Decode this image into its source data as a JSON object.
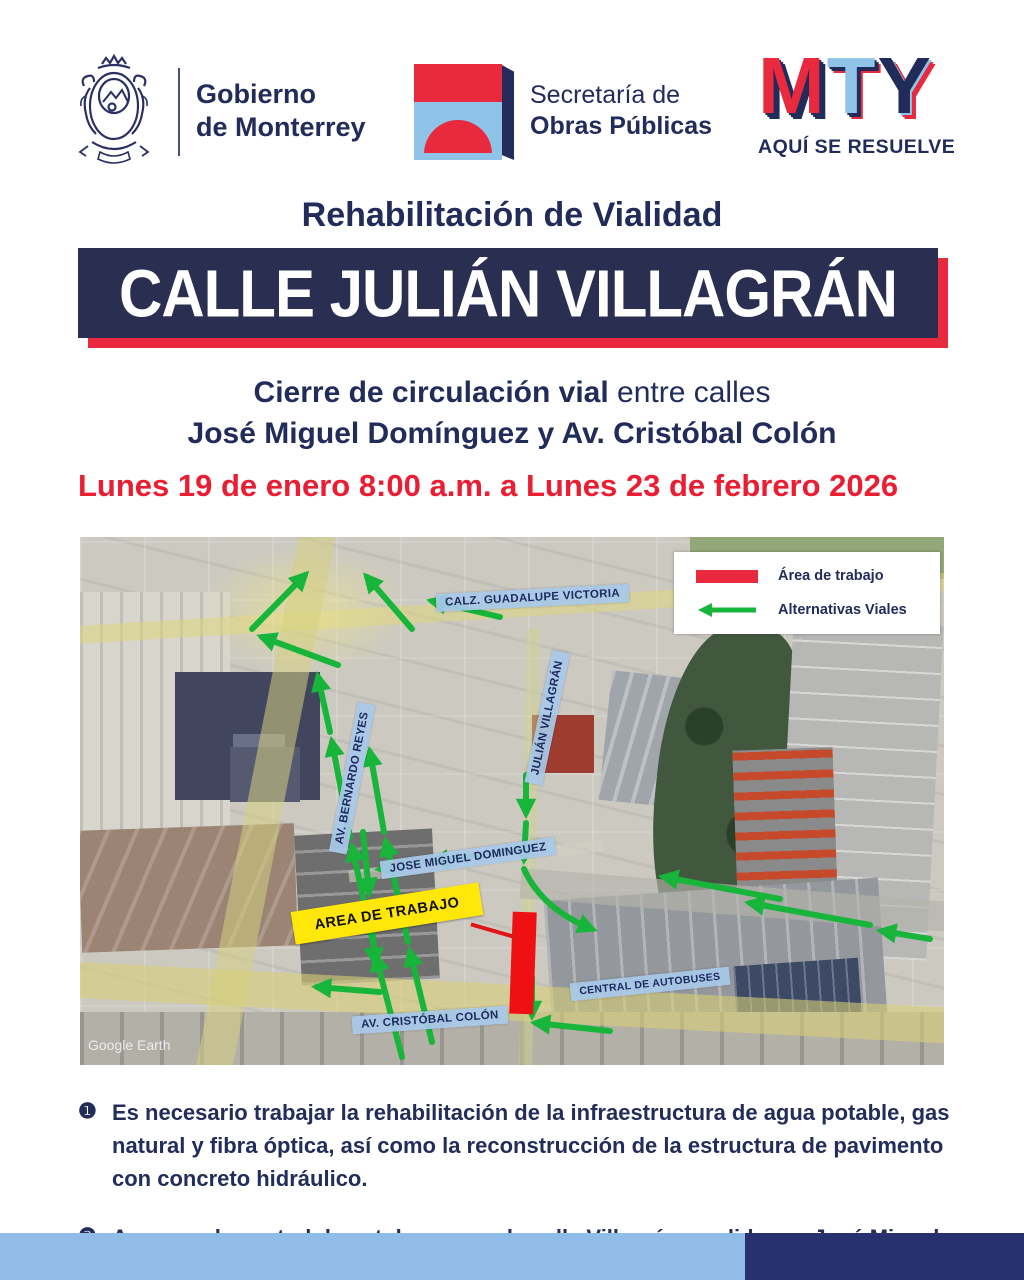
{
  "colors": {
    "navy_text": "#222c5b",
    "banner_navy": "#2a2f52",
    "accent_red": "#e8293e",
    "date_red": "#ea1d32",
    "work_area_red": "#ee1012",
    "label_blue": "#a6c6e8",
    "logo_light_blue": "#8fc3e8",
    "route_green": "#17b53a",
    "work_label_yellow": "#ffe70a",
    "footer_light_blue": "#92bce8",
    "footer_navy": "#283070"
  },
  "header": {
    "monterrey": {
      "line1": "Gobierno",
      "line2": "de Monterrey",
      "emblem": "monterrey-coat-of-arms"
    },
    "obras_publicas": {
      "line1": "Secretaría de",
      "line2": "Obras Públicas"
    },
    "mty": {
      "m": "M",
      "t": "T",
      "y": "Y",
      "tagline": "AQUÍ SE RESUELVE"
    }
  },
  "title": "Rehabilitación de Vialidad",
  "banner": "CALLE JULIÁN VILLAGRÁN",
  "subtitle": {
    "line1_bold": "Cierre de circulación vial",
    "line1_regular": " entre calles",
    "line2": "José Miguel Domínguez y Av. Cristóbal Colón"
  },
  "date_line": "Lunes 19 de enero 8:00 a.m. a Lunes 23 de febrero 2026",
  "map": {
    "legend": {
      "work_area": "Área de trabajo",
      "alternatives": "Alternativas Viales"
    },
    "labels": {
      "guadalupe": "CALZ. GUADALUPE VICTORIA",
      "bernardo": "AV. BERNARDO REYES",
      "villagran": "JULIÁN VILLAGRÁN",
      "dominguez": "JOSE MIGUEL DOMINGUEZ",
      "work_area": "AREA DE TRABAJO",
      "central": "CENTRAL DE AUTOBUSES",
      "colon": "AV. CRISTÓBAL COLÓN"
    },
    "watermark": "Google Earth"
  },
  "notes": [
    {
      "num": "❶",
      "text": "Es necesario trabajar la rehabilitación de la infraestructura de agua potable, gas natural y fibra óptica, así como la reconstrucción de la estructura de pavimento con concreto hidráulico."
    },
    {
      "num": "❷",
      "text": "Acceso a la central de autobuses por la calle Villagrán y salida por José Miguel Domínguez."
    }
  ]
}
